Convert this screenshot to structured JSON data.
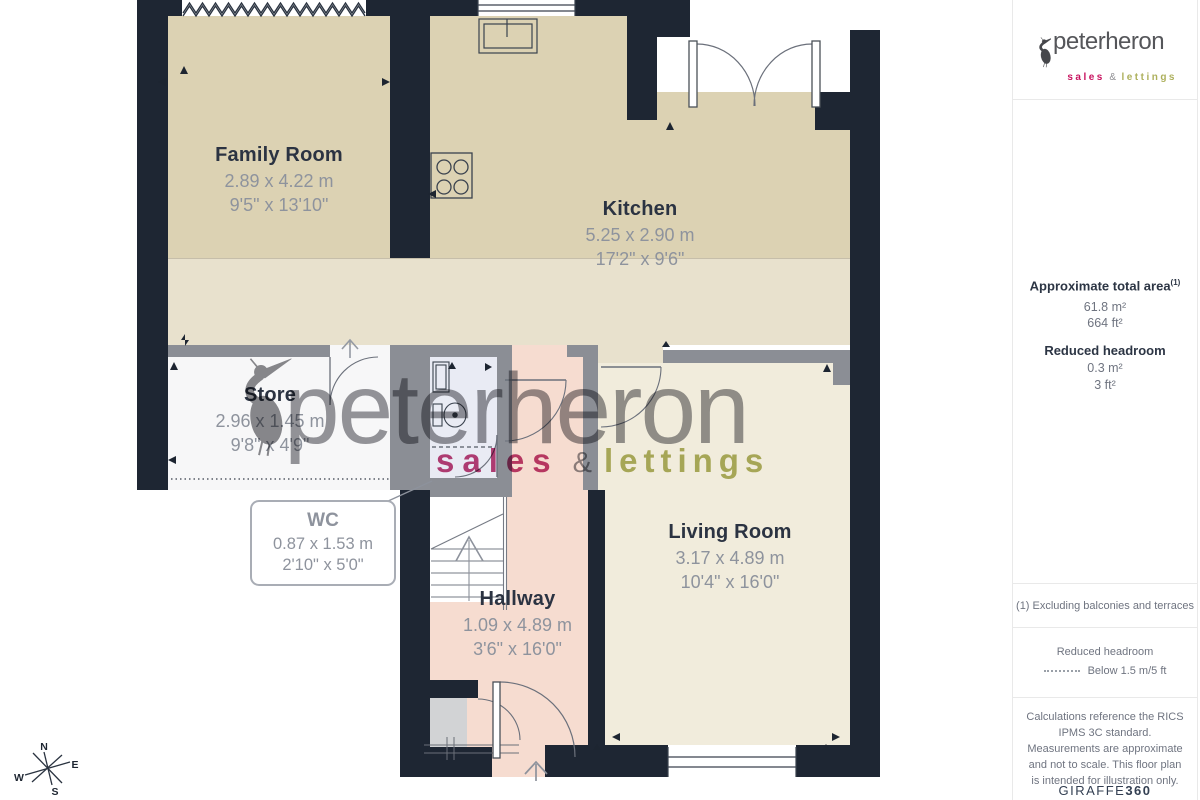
{
  "logo": {
    "name": "peterheron",
    "sales": "sales",
    "amp": "&",
    "lettings": "lettings"
  },
  "watermark": {
    "name": "peterheron",
    "sales": "sales",
    "amp": "&",
    "lettings": "lettings"
  },
  "sidebar": {
    "area": {
      "title": "Approximate total area",
      "sup": "(1)",
      "m2": "61.8 m²",
      "ft2": "664 ft²"
    },
    "headroom": {
      "title": "Reduced headroom",
      "m2": "0.3 m²",
      "ft2": "3 ft²"
    },
    "note": "(1) Excluding balconies and terraces",
    "legend": {
      "title": "Reduced headroom",
      "desc": "Below 1.5 m/5 ft"
    },
    "disclaimer": "Calculations reference the RICS IPMS 3C standard. Measurements are approximate and not to scale. This floor plan is intended for illustration only.",
    "brand_regular": "GIRAFFE",
    "brand_bold": "360"
  },
  "rooms": [
    {
      "name": "Family Room",
      "metric": "2.89 x 4.22 m",
      "imperial": "9'5\" x 13'10\""
    },
    {
      "name": "Kitchen",
      "metric": "5.25 x 2.90 m",
      "imperial": "17'2\" x 9'6\""
    },
    {
      "name": "Store",
      "metric": "2.96 x 1.45 m",
      "imperial": "9'8\" x 4'9\""
    },
    {
      "name": "WC",
      "metric": "0.87 x 1.53 m",
      "imperial": "2'10\" x 5'0\""
    },
    {
      "name": "Hallway",
      "metric": "1.09 x 4.89 m",
      "imperial": "3'6\" x 16'0\""
    },
    {
      "name": "Living Room",
      "metric": "3.17 x 4.89 m",
      "imperial": "10'4\" x 16'0\""
    }
  ],
  "compass": {
    "n": "N",
    "e": "E",
    "s": "S",
    "w": "W"
  },
  "colors": {
    "wall_dark": "#1e2633",
    "wall_gray": "#8b8e95",
    "room_beige": "#dcd2b3",
    "room_cream": "#e8e1cd",
    "room_living": "#f1ecdc",
    "room_pink": "#f6dcd0",
    "room_wc": "#e9ebf4",
    "accent_sales": "#c8135f",
    "accent_lettings": "#adb05c"
  }
}
